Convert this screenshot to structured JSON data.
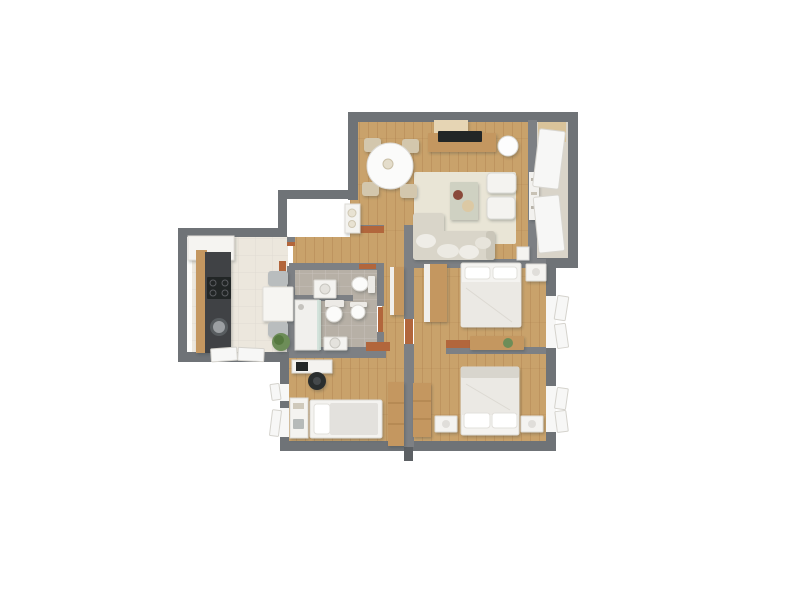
{
  "scene": {
    "kind": "3d-floor-plan-top-down-render",
    "background": "#ffffff"
  },
  "palette": {
    "bg": "#ffffff",
    "wall": "#6f7377",
    "wall-light": "#7d8084",
    "wall-dark": "#5c6064",
    "wood": "#c9a26b",
    "wood-grain": "#a87c46",
    "wood-furn": "#c49760",
    "kitchen-floor": "#ece7dd",
    "tile": "#b7b0a6",
    "balcony-floor": "#d9d4c9",
    "rug": "#e9e5d6",
    "white-furn": "#f4f3f0",
    "bed-linen": "#ebe9e4",
    "sofa": "#d9d5c9",
    "counter-dark": "#3f4245",
    "appliance-dark": "#232527",
    "door": "#b2663c",
    "chair-beige": "#d3c7ad",
    "chair-gray": "#b9bdbe",
    "plant": "#6d8d58",
    "plant-dark": "#57793f",
    "glass": "#cfe0d8",
    "window-white": "#f7f7f6"
  },
  "rooms": [
    {
      "id": "living-dining-room",
      "floor": "wood",
      "furniture": [
        "round-dining-table",
        "dining-chair",
        "dining-chair",
        "dining-chair",
        "dining-chair",
        "tv-sideboard",
        "tv",
        "floor-lamp",
        "area-rug",
        "coffee-table",
        "armchair",
        "armchair",
        "sofa-with-chaise",
        "wall-shelf",
        "corner-unit"
      ]
    },
    {
      "id": "balcony",
      "floor": "stone",
      "furniture": [
        "window-panel",
        "window-panel"
      ]
    },
    {
      "id": "kitchen",
      "floor": "light-tile",
      "furniture": [
        "upper-cabinet",
        "counter-run",
        "cooktop",
        "round-sink",
        "table-for-two",
        "chair",
        "chair",
        "potted-plant"
      ]
    },
    {
      "id": "wc",
      "floor": "gray-tile",
      "furniture": [
        "washbasin-cabinet",
        "toilet"
      ]
    },
    {
      "id": "bathroom",
      "floor": "gray-tile",
      "furniture": [
        "shower",
        "toilet",
        "bidet",
        "washbasin"
      ]
    },
    {
      "id": "bedroom-right",
      "floor": "wood",
      "furniture": [
        "double-bed",
        "wardrobe",
        "nightstand",
        "dresser",
        "plant"
      ]
    },
    {
      "id": "bedroom-bottom-right",
      "floor": "wood",
      "furniture": [
        "double-bed",
        "nightstand",
        "nightstand",
        "wardrobe"
      ]
    },
    {
      "id": "kids-room",
      "floor": "wood",
      "furniture": [
        "desk",
        "desk-chair",
        "single-bed",
        "shelf-unit",
        "wardrobe"
      ]
    },
    {
      "id": "hallway",
      "floor": "wood",
      "furniture": [
        "console-table",
        "hall-cabinet"
      ]
    }
  ],
  "doors": [
    {
      "id": "door-living",
      "between": [
        "hallway",
        "living-dining-room"
      ]
    },
    {
      "id": "door-kitchen",
      "between": [
        "hallway",
        "kitchen"
      ]
    },
    {
      "id": "door-wc",
      "between": [
        "hallway",
        "wc"
      ]
    },
    {
      "id": "door-bathroom",
      "between": [
        "hallway",
        "bathroom"
      ]
    },
    {
      "id": "door-bedroom-right",
      "between": [
        "hallway",
        "bedroom-right"
      ]
    },
    {
      "id": "door-kids-room",
      "between": [
        "hallway",
        "kids-room"
      ]
    },
    {
      "id": "door-bedroom-bottom-right",
      "between": [
        "hallway",
        "bedroom-bottom-right"
      ]
    }
  ],
  "windows": [
    {
      "id": "window-bedroom-right",
      "wall": "east",
      "state": "open"
    },
    {
      "id": "window-bedroom-bottom-right",
      "wall": "east",
      "state": "open"
    },
    {
      "id": "window-kids-room-upper",
      "wall": "west",
      "state": "open"
    },
    {
      "id": "window-kids-room-lower",
      "wall": "west",
      "state": "open"
    },
    {
      "id": "window-kitchen",
      "wall": "south",
      "state": "open"
    },
    {
      "id": "balcony-glazing",
      "wall": "east",
      "state": "closed"
    }
  ]
}
